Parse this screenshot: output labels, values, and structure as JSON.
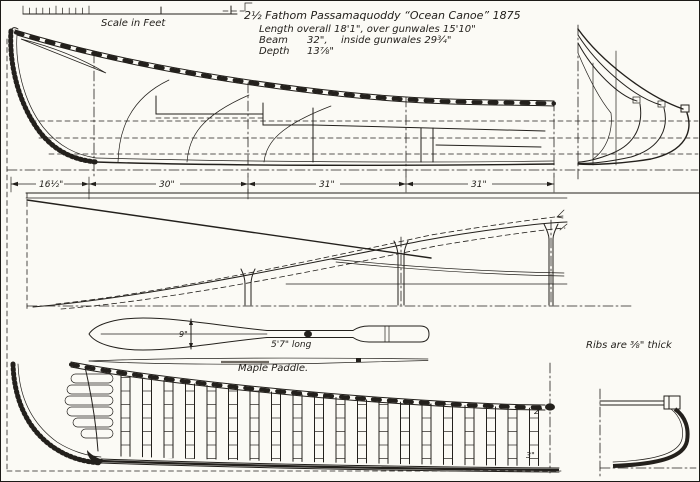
{
  "colors": {
    "ink": "#23201c",
    "paper": "#fbfaf5"
  },
  "scale_bar": {
    "label": "Scale in Feet"
  },
  "title_block": {
    "line1": "2½ Fathom Passamaquoddy “Ocean Canoe” 1875",
    "length_line": "Length overall 18'1\", over gunwales 15'10\"",
    "beam_label": "Beam",
    "beam_value": "32\",",
    "beam_rest": "inside gunwales 29¾\"",
    "depth_label": "Depth",
    "depth_value": "13⅞\""
  },
  "dimension_line": {
    "segments": [
      "16½\"",
      "30\"",
      "31\"",
      "31\""
    ]
  },
  "paddle": {
    "length_label": "5'7\" long",
    "name_label": "Maple Paddle.",
    "blade_width_label": "9\""
  },
  "interior_view": {
    "gunwale_thickness_label": "2\"",
    "keel_label": "3\""
  },
  "notes": {
    "ribs_note": "Ribs are ⅜\" thick"
  }
}
